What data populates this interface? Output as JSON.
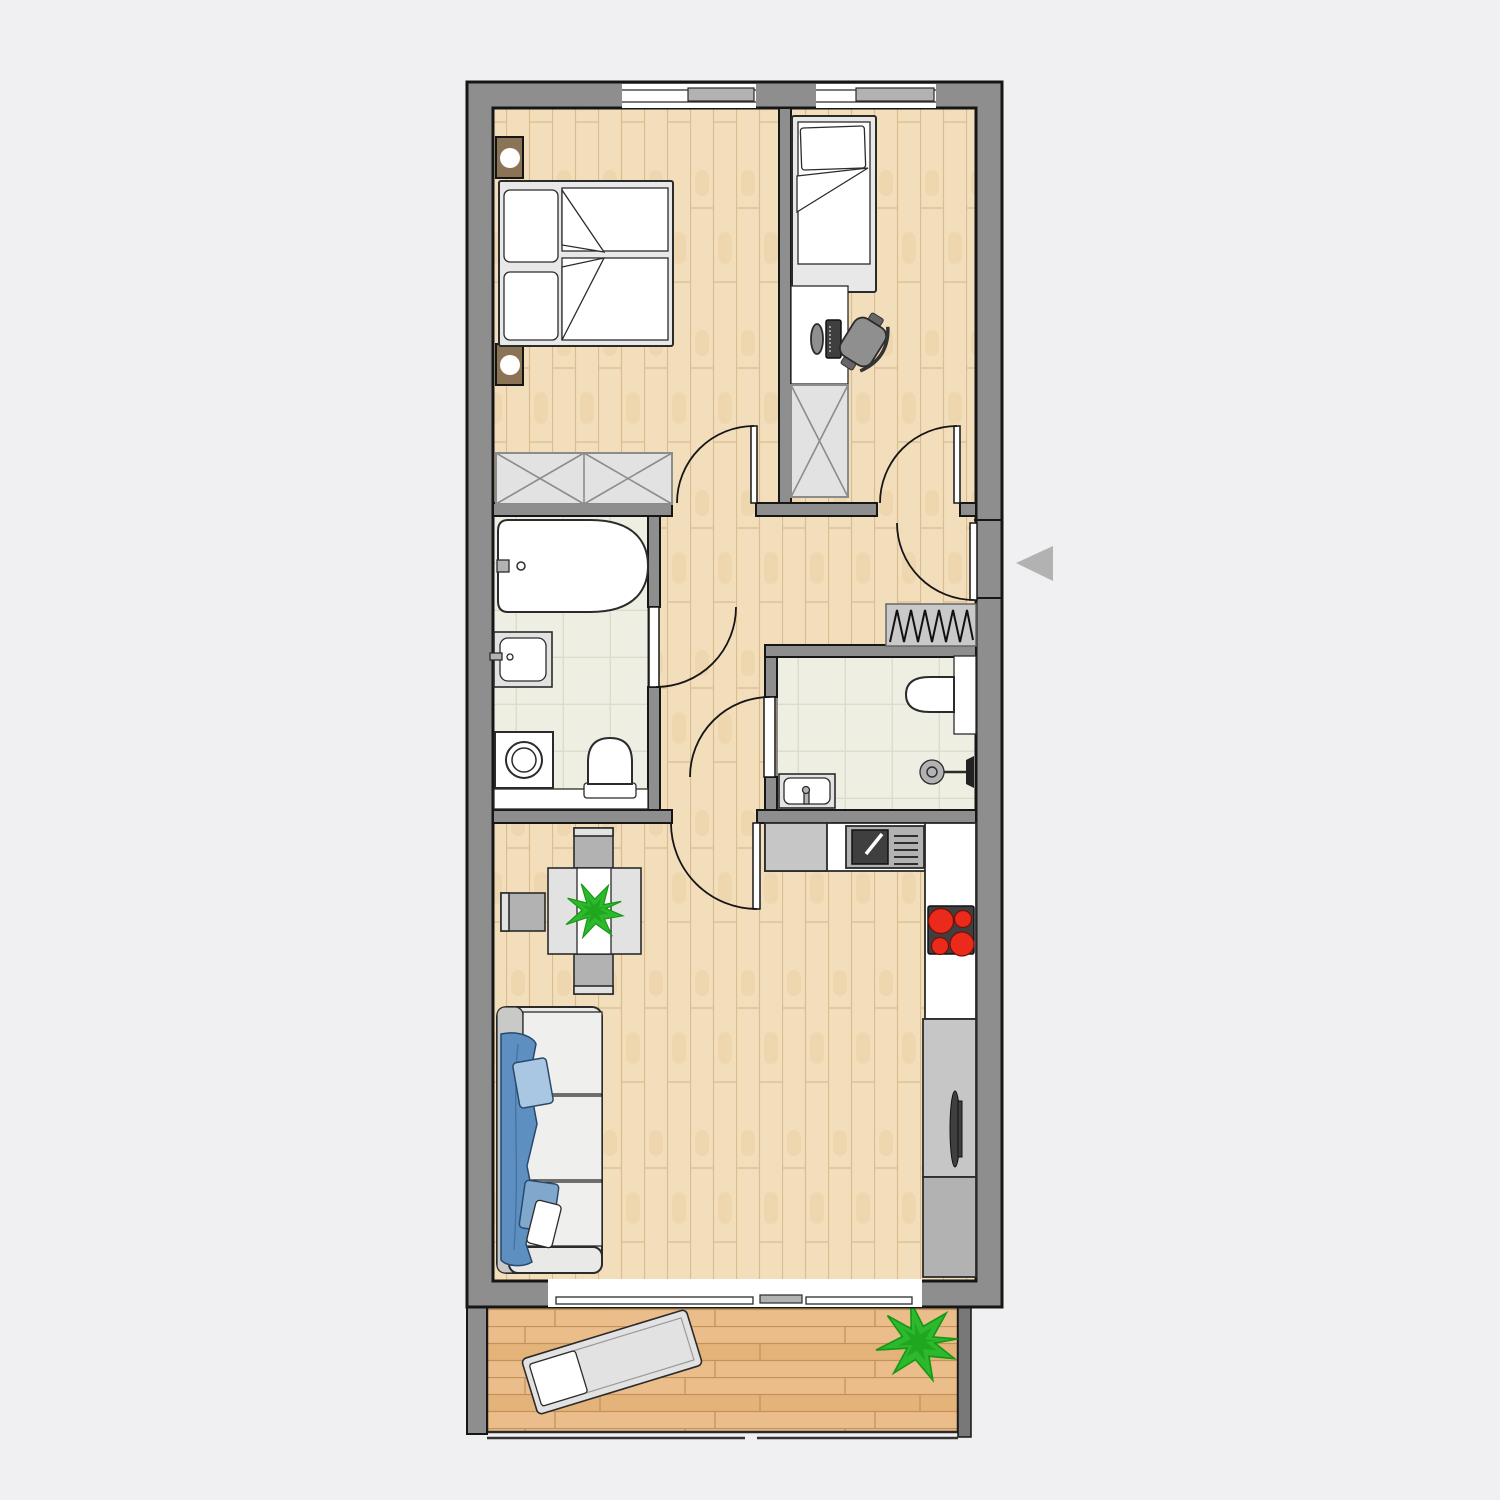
{
  "meta": {
    "description": "Top-down architectural floor plan of a two-bedroom apartment with bathroom, separate shower WC, hallway, open living room with kitchen, and a balcony with sun lounger; entrance marked with a gray arrow on the right side"
  },
  "colors": {
    "background": "#f0f0f3",
    "wall_fill": "#8e8e8e",
    "wall_stroke": "#161616",
    "outline": "#2b2b2b",
    "white": "#ffffff",
    "wood_base": "#f3debc",
    "wood_line": "#d9bd8f",
    "wood_grain": "#e9d0a4",
    "deck_base": "#eabd8a",
    "deck_alt": "#e2af74",
    "deck_line": "#c2915c",
    "tile_base": "#efeee2",
    "tile_line": "#dddcca",
    "furn_light": "#e2e2e2",
    "furn_gray": "#c6c6c6",
    "furn_mid": "#b2b2b2",
    "furn_dark": "#8c8c8c",
    "furn_frame": "#e8e8e8",
    "chair_dark": "#8f8f8f",
    "nightstand": "#8b7355",
    "appliance_dark": "#3f3f3f",
    "burner_red": "#ea2a1a",
    "radiator": "#c9c9c9",
    "sofa_body": "#e9e9e7",
    "sofa_back": "#c9c9c7",
    "sofa_cushion": "#efefed",
    "sofa_blanket": "#5d8fc0",
    "sofa_pillow": "#a9c7e2",
    "sofa_pillow2": "#7fa8cc",
    "plant": "#2eb82e",
    "plant_dark": "#159915",
    "arrow": "#b2b2b2"
  },
  "rooms": [
    {
      "name": "bedroom-1",
      "floor": "wood",
      "position": "top-left"
    },
    {
      "name": "bedroom-2",
      "floor": "wood",
      "position": "top-right"
    },
    {
      "name": "bathroom",
      "floor": "tile",
      "position": "middle-left"
    },
    {
      "name": "hallway",
      "floor": "wood",
      "position": "middle"
    },
    {
      "name": "shower-wc",
      "floor": "tile",
      "position": "middle-right"
    },
    {
      "name": "living-room-with-kitchen",
      "floor": "wood",
      "position": "bottom"
    },
    {
      "name": "balcony",
      "floor": "deck",
      "position": "below-living-room"
    }
  ],
  "furniture": [
    "double-bed",
    "nightstand-with-lamp-top",
    "nightstand-with-lamp-bottom",
    "wardrobe-bedroom-1",
    "single-bed",
    "desk-with-computer",
    "office-chair",
    "wardrobe-bedroom-2",
    "bathtub",
    "bathroom-sink",
    "washing-machine",
    "bathroom-toilet",
    "wc-toilet",
    "wc-cistern",
    "shower-fixture",
    "wc-sink",
    "radiator",
    "kitchen-sink",
    "cooktop-4-burners",
    "fridge-tall-cabinet",
    "kitchen-cabinet",
    "dining-table-with-plant",
    "dining-chair-top",
    "dining-chair-left",
    "dining-chair-bottom",
    "sofa-with-blue-blanket-and-pillows",
    "sun-lounger",
    "balcony-plant"
  ],
  "entry": {
    "arrow_direction": "left",
    "side": "right-wall"
  }
}
